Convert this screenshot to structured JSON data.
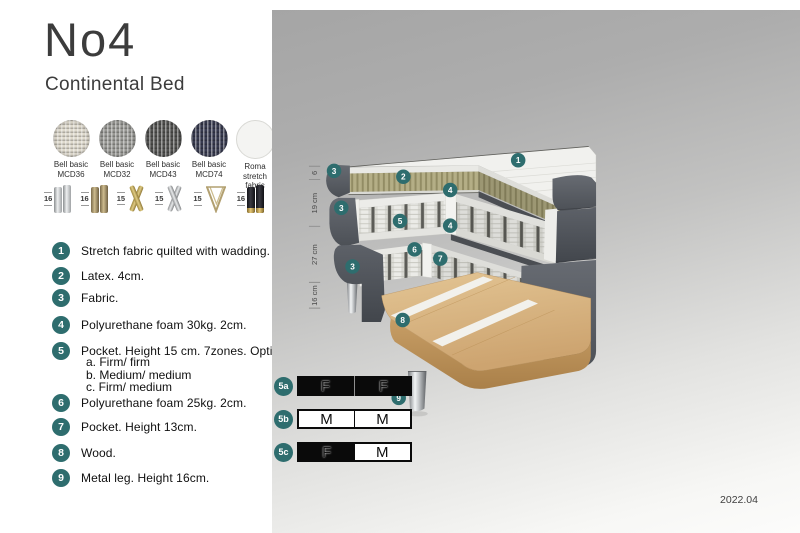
{
  "title": "No4",
  "subtitle": "Continental Bed",
  "fabrics": [
    {
      "line1": "Bell basic",
      "line2": "MCD36"
    },
    {
      "line1": "Bell basic",
      "line2": "MCD32"
    },
    {
      "line1": "Bell basic",
      "line2": "MCD43"
    },
    {
      "line1": "Bell basic",
      "line2": "MCD74"
    },
    {
      "line1": "Roma",
      "line2": "stretch fabric"
    }
  ],
  "legs": [
    {
      "height": "16",
      "type": "cylinder-silver"
    },
    {
      "height": "16",
      "type": "cylinder-bronze"
    },
    {
      "height": "15",
      "type": "cross-gold"
    },
    {
      "height": "15",
      "type": "cross-silver"
    },
    {
      "height": "15",
      "type": "hairpin"
    },
    {
      "height": "16",
      "type": "cylinder-black-gold"
    }
  ],
  "features": [
    {
      "num": "1",
      "text": "Stretch fabric quilted with wadding."
    },
    {
      "num": "2",
      "text": "Latex. 4cm."
    },
    {
      "num": "3",
      "text": "Fabric."
    },
    {
      "num": "4",
      "text": "Polyurethane foam 30kg. 2cm."
    },
    {
      "num": "5",
      "text": "Pocket. Height 15 cm. 7zones. Option:",
      "options": [
        "a. Firm/ firm",
        "b. Medium/ medium",
        "c. Firm/ medium"
      ]
    },
    {
      "num": "6",
      "text": "Polyurethane foam 25kg. 2cm."
    },
    {
      "num": "7",
      "text": "Pocket. Height 13cm."
    },
    {
      "num": "8",
      "text": "Wood."
    },
    {
      "num": "9",
      "text": "Metal leg. Height 16cm."
    }
  ],
  "diagram": {
    "dimensions": [
      "6",
      "19 cm",
      "27 cm",
      "16 cm"
    ],
    "callouts": [
      "1",
      "2",
      "3",
      "4",
      "3",
      "5",
      "4",
      "6",
      "7",
      "3",
      "8",
      "9"
    ],
    "firmness": [
      {
        "id": "5a",
        "left": "F",
        "right": "F"
      },
      {
        "id": "5b",
        "left": "M",
        "right": "M"
      },
      {
        "id": "5c",
        "left": "F",
        "right": "M"
      }
    ],
    "version": "2022.04"
  },
  "colors": {
    "teal": "#2e6d6e",
    "panel_top": "#a5a5a5",
    "panel_bottom": "#fcfcfb",
    "latex": "#b4ae86",
    "wood": "#d9b886",
    "dark_fabric": "#52565c"
  }
}
